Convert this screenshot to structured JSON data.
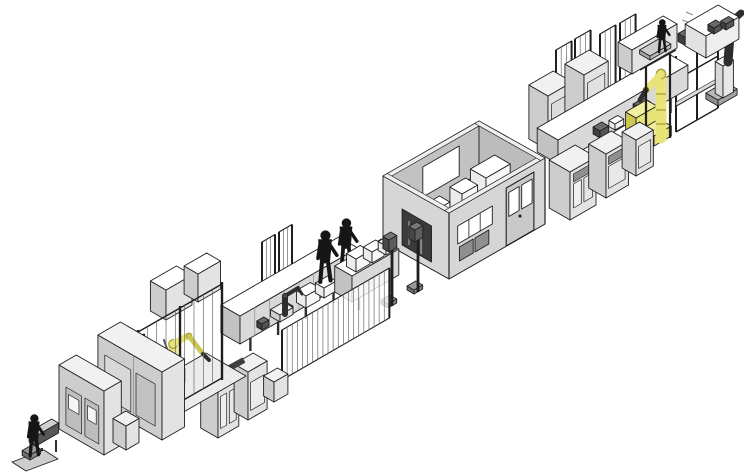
{
  "scene": {
    "kind": "isometric-cad-illustration",
    "subject": "automated-production-line",
    "background_color": "#ffffff",
    "line_orientation": "lower-left-to-upper-right",
    "stations": [
      {
        "name": "line-end-operator-station",
        "elements": [
          "operator-figure",
          "floor-plate",
          "infeed-conveyor-stub"
        ]
      },
      {
        "name": "left-machine-cluster",
        "elements": [
          "large-machine-cabinet",
          "large-machine-cabinet",
          "small-service-cabinet"
        ]
      },
      {
        "name": "left-robot-cell",
        "elements": [
          "yellow-robot-arm",
          "yellow-pedestal",
          "safety-fence-posts",
          "back-cabinets",
          "side-fence-panels"
        ]
      },
      {
        "name": "mid-conveyor-section",
        "elements": [
          "conveyor-machines",
          "white-part-boxes",
          "small-dark-robot",
          "operator-figure",
          "operator-figure",
          "signal-posts",
          "barred-safety-fence",
          "back-fence-panels",
          "front-cabinets",
          "infeed-conveyor"
        ]
      },
      {
        "name": "central-enclosure-room",
        "elements": [
          "gray-walls",
          "back-wall-windows",
          "end-wall-window",
          "door-with-panes",
          "front-window-strip",
          "drawer-panels",
          "interior-white-machines",
          "interior-yellow-robot",
          "dark-infeed-opening",
          "hazard-marker"
        ]
      },
      {
        "name": "right-machine-section",
        "elements": [
          "fence-door-panels",
          "storage-rack",
          "overhead-conveyor",
          "big-cabinet-row",
          "front-machine-cabinets",
          "yellow-robot-arm",
          "cell-posts",
          "operator-platform",
          "operator-figure",
          "top-cabinet"
        ]
      },
      {
        "name": "line-end-pedestal-robot",
        "elements": [
          "articulated-robot-arm",
          "pedestal-column",
          "base-plate",
          "control-console"
        ]
      }
    ],
    "counts": {
      "yellow_robots": 3,
      "dark_robot_arms": 2,
      "operator_figures": 4,
      "enclosure_rooms": 1,
      "fence_panel_groups": 6
    }
  },
  "colors": {
    "background": "#ffffff",
    "outline": "#1f1f1f",
    "face_top": "#f1f1f1",
    "face_light": "#e3e3e3",
    "face_mid": "#cdcdcd",
    "face_dark": "#b5b5b5",
    "panel_dark": "#8f8f8f",
    "detail_dark": "#3c3c3c",
    "wall": "#d6d6d6",
    "wall_shade": "#c2c2c2",
    "wall_top": "#efefef",
    "interior_dark": "#3b3b3b",
    "white": "#ffffff",
    "robot_yellow": "#e9e478",
    "robot_yellow_shade": "#cdc650",
    "robot_olive": "#8e8a35",
    "robot_dark": "#2e2e2e",
    "figure": "#161616",
    "hazard_yellow": "#e8d34a",
    "fence_bar": "#6b6b6b"
  }
}
